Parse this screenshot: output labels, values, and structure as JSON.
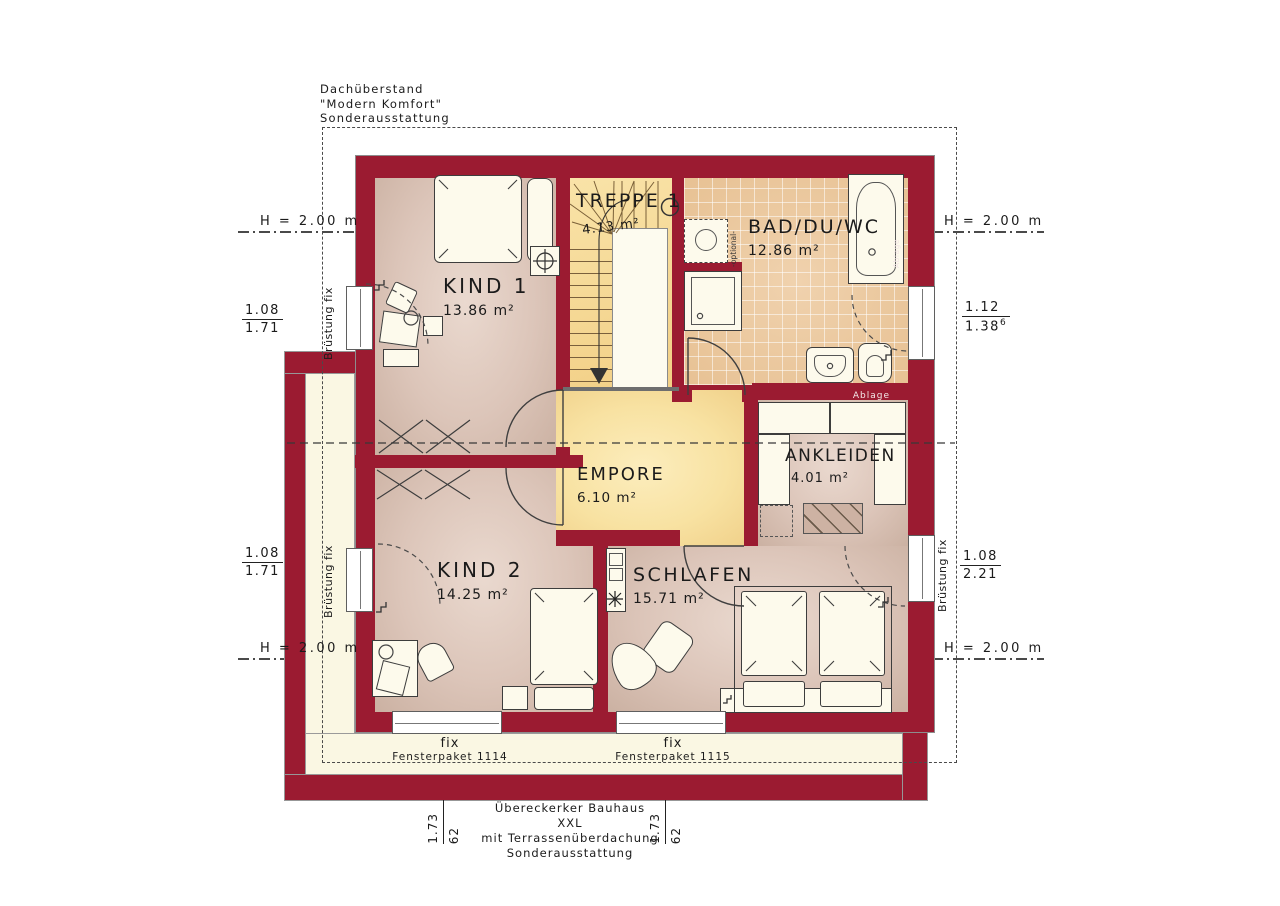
{
  "plan": {
    "roof_note": {
      "line1": "Dachüberstand",
      "line2": "\"Modern Komfort\"",
      "line3": "Sonderausstattung"
    },
    "footer_note": {
      "line1": "Übereckerker Bauhaus XXL",
      "line2": "mit Terrassenüberdachung",
      "line3": "Sonderausstattung"
    }
  },
  "rooms": {
    "treppe": {
      "name": "TREPPE 1",
      "area": "4.13 m²"
    },
    "bad": {
      "name": "BAD/DU/WC",
      "area": "12.86 m²"
    },
    "kind1": {
      "name": "KIND 1",
      "area": "13.86 m²"
    },
    "empore": {
      "name": "EMPORE",
      "area": "6.10 m²"
    },
    "ankleiden": {
      "name": "ANKLEIDEN",
      "area": "4.01 m²"
    },
    "kind2": {
      "name": "KIND 2",
      "area": "14.25 m²"
    },
    "schlafen": {
      "name": "SCHLAFEN",
      "area": "15.71 m²"
    }
  },
  "dimensions": {
    "height_marker": "H = 2.00 m",
    "left_top": {
      "num": "1.08",
      "den": "1.71"
    },
    "right_top": {
      "num": "1.12",
      "den": "1.38",
      "sup": "6"
    },
    "left_bottom": {
      "num": "1.08",
      "den": "1.71"
    },
    "right_bottom": {
      "num": "1.08",
      "den": "2.21"
    },
    "bottom": {
      "a": "1.73",
      "b": "62"
    }
  },
  "labels": {
    "bruestung_fix": "Brüstung fix",
    "raumhoch": "raumhoch",
    "optional": "-optional-",
    "ablage": "Ablage",
    "fix": "fix",
    "fensterpaket_1": "Fensterpaket 1114",
    "fensterpaket_2": "Fensterpaket 1115"
  },
  "colors": {
    "wall": "#9b1b31",
    "room_floor": "#dcc5b9",
    "gallery_floor": "#f8e2a2",
    "stair_floor": "#f6d794",
    "bath_tile": "#ecc9a1",
    "cream": "#faf7e3",
    "line": "#3a3a3a"
  }
}
